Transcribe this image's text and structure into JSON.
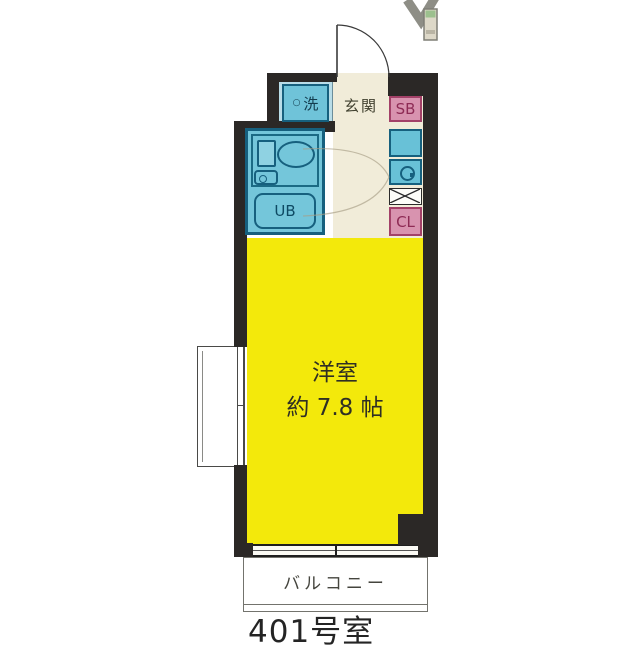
{
  "floorplan": {
    "title": "apartment floor plan",
    "room_number": "401号室",
    "areas": {
      "entrance": {
        "label": "玄関"
      },
      "laundry": {
        "marker": "○",
        "label": "洗"
      },
      "shoe_box": {
        "label": "SB"
      },
      "closet": {
        "label": "CL"
      },
      "unit_bath": {
        "label": "UB"
      },
      "main_room": {
        "label": "洋室",
        "size": "約 7.8 帖"
      },
      "balcony": {
        "label": "バルコニー"
      }
    },
    "colors": {
      "wall": "#2b2826",
      "main_room_fill": "#f3e90b",
      "wet_area_fill": "#68c1d7",
      "wet_area_border": "#16607e",
      "storage_fill": "#d893af",
      "storage_border": "#a34168",
      "corridor_fill": "#f1ecd9"
    }
  }
}
